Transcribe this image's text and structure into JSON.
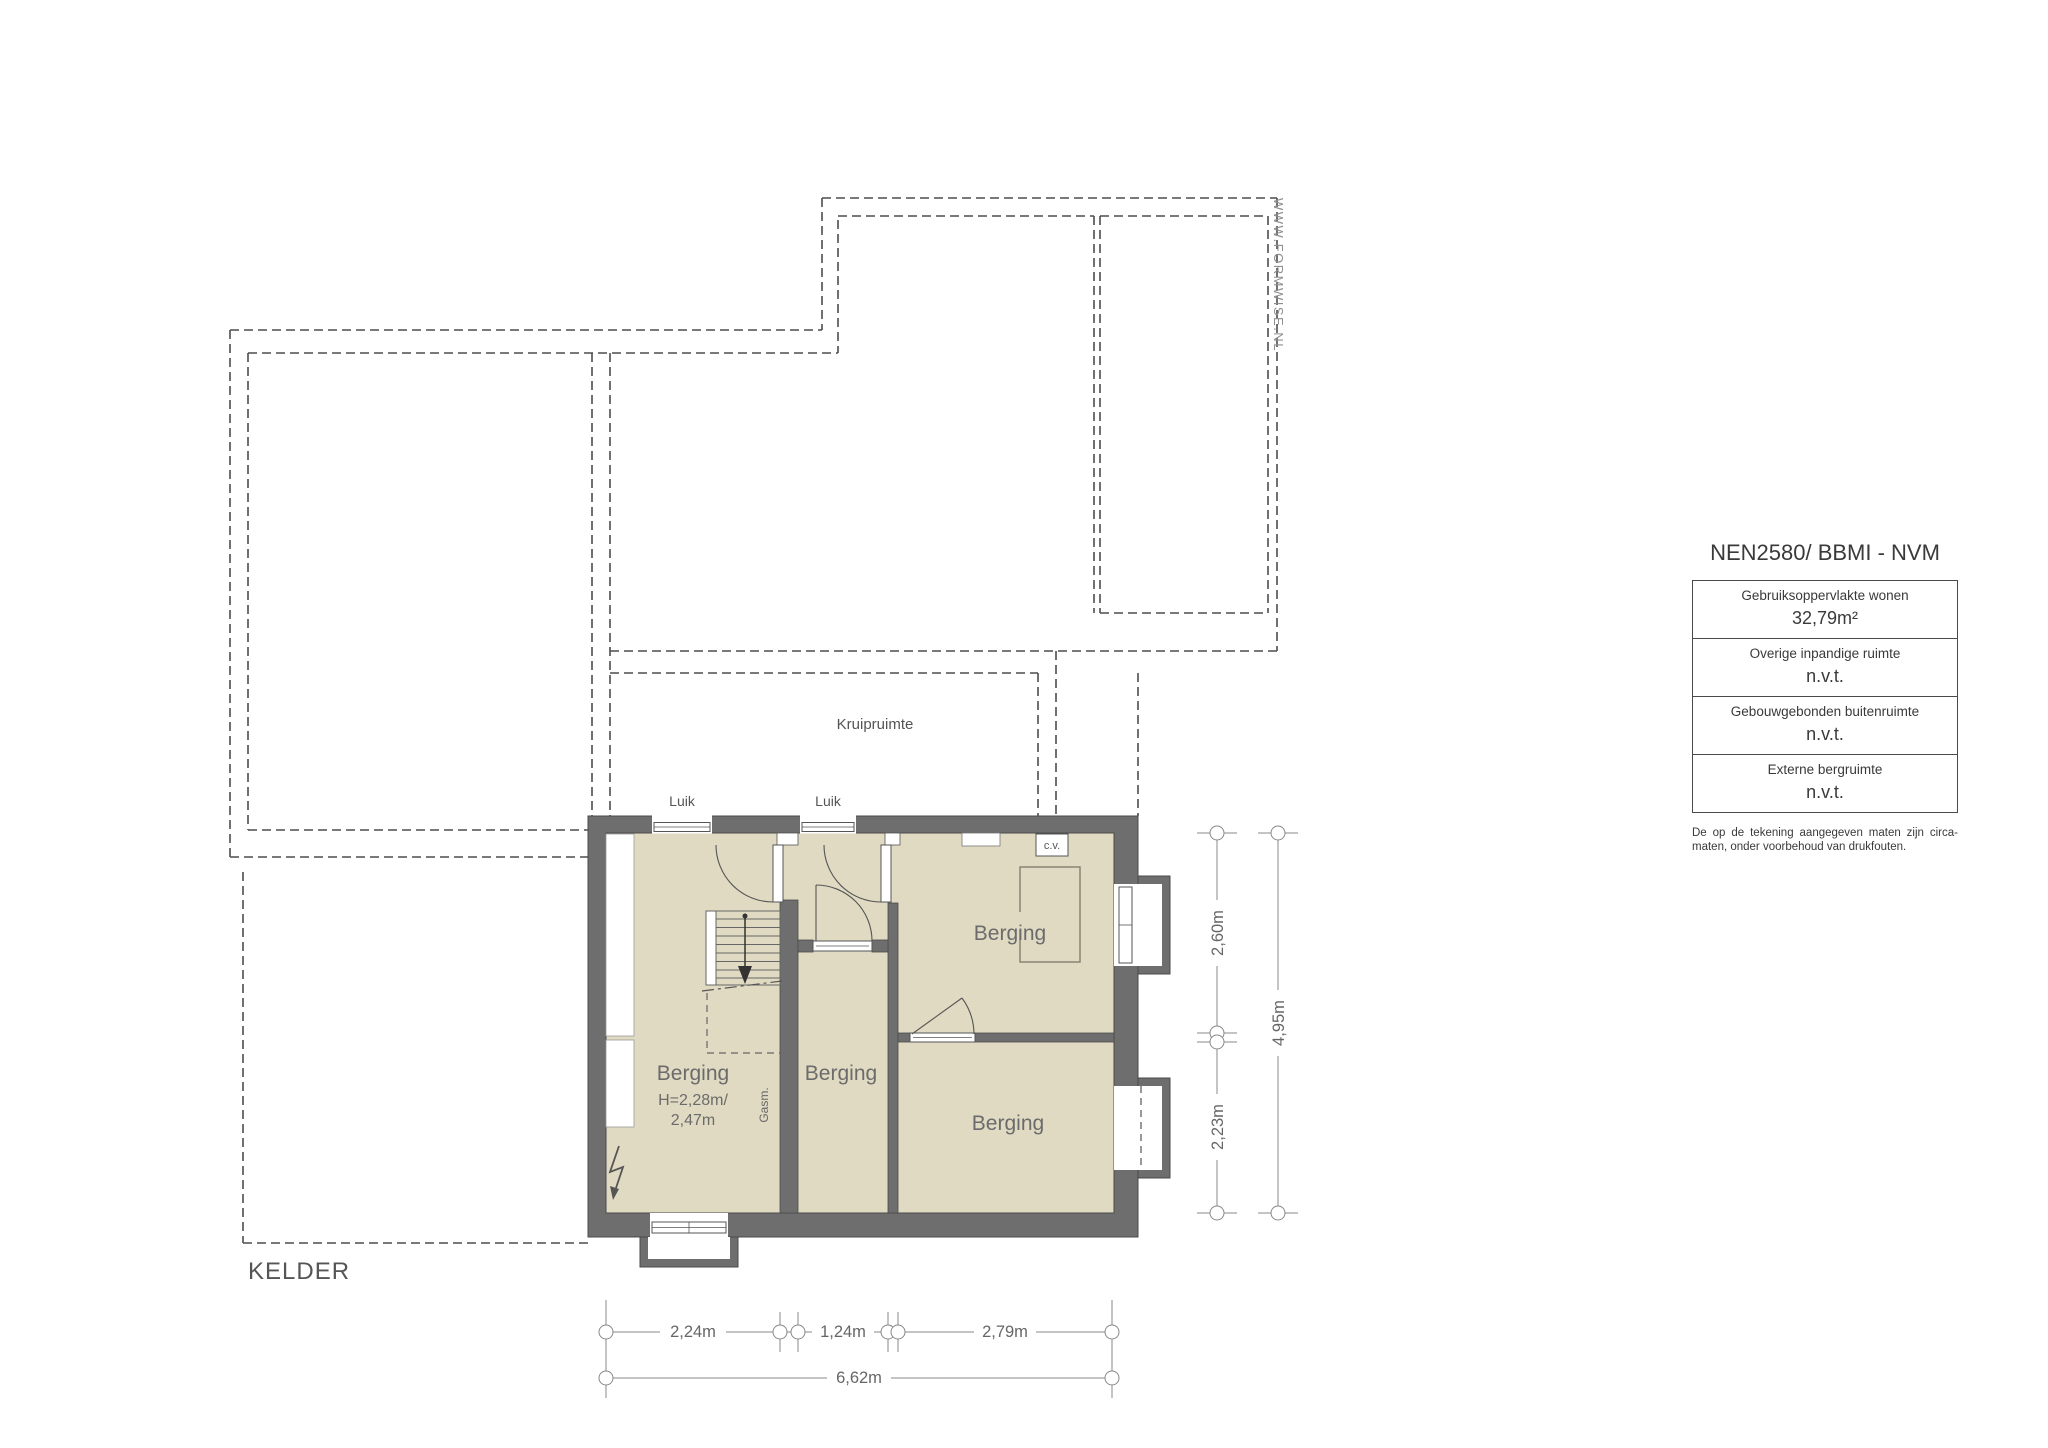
{
  "watermark": {
    "text": "WWW.FORMWISE.NL"
  },
  "plan": {
    "title": "KELDER",
    "crawl_space_label": "Kruipruimte",
    "hatch_label_1": "Luik",
    "hatch_label_2": "Luik",
    "cv_label": "c.v.",
    "gas_meter_label": "Gasm.",
    "rooms": [
      {
        "label": "Berging",
        "height_note_line1": "H=2,28m/",
        "height_note_line2": "2,47m"
      },
      {
        "label": "Berging"
      },
      {
        "label": "Berging"
      },
      {
        "label": "Berging"
      }
    ],
    "dimensions": {
      "bottom_segments": [
        "2,24m",
        "1,24m",
        "2,79m"
      ],
      "bottom_total": "6,62m",
      "right_segments": [
        "2,60m",
        "2,23m"
      ],
      "right_total": "4,95m"
    },
    "colors": {
      "wall": "#6e6e6e",
      "floor": "#e0dac3",
      "outline": "#4d4d4d"
    }
  },
  "legend": {
    "title": "NEN2580/ BBMI - NVM",
    "rows": [
      {
        "label": "Gebruiksoppervlakte wonen",
        "value": "32,79m²"
      },
      {
        "label": "Overige inpandige ruimte",
        "value": "n.v.t."
      },
      {
        "label": "Gebouwgebonden buitenruimte",
        "value": "n.v.t."
      },
      {
        "label": "Externe bergruimte",
        "value": "n.v.t."
      }
    ],
    "footnote": "De op de tekening aangegeven maten zijn circa-maten, onder voorbehoud van drukfouten."
  }
}
